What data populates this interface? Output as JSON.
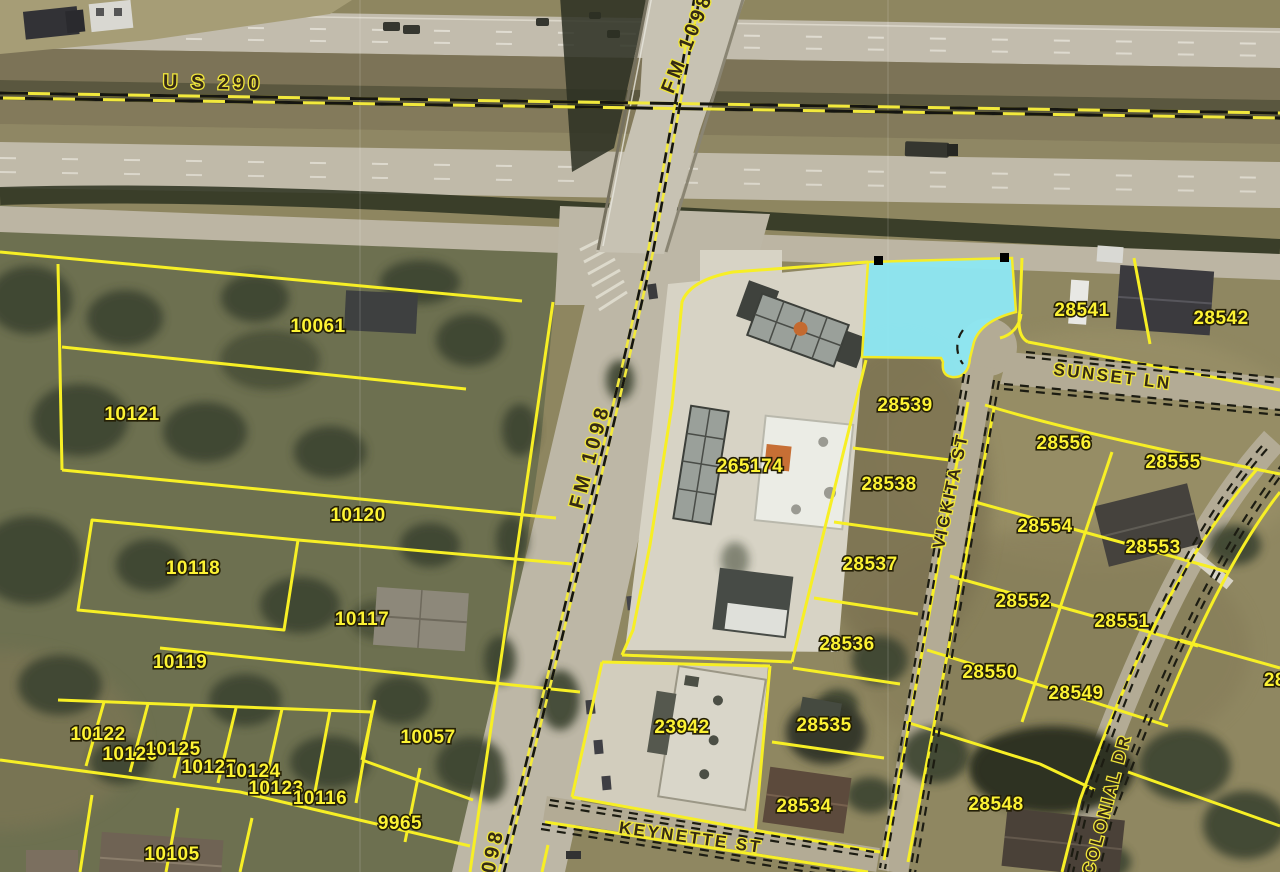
{
  "map": {
    "type": "aerial-parcel-map",
    "colors": {
      "parcel_line": "#f7ef25",
      "parcel_label_fill": "#fdf334",
      "street_label_fill": "#352a15",
      "highlight_parcel_fill": "#8ee7f2",
      "centerline_yellow": "#f2e93c",
      "centerline_black": "#151510"
    },
    "highways": [
      "U S 290",
      "FM 1098"
    ],
    "streets": [
      "SUNSET LN",
      "VICKITA ST",
      "KEYNETTE ST",
      "COLONIAL DR"
    ],
    "parcel_ids": [
      "10061",
      "10121",
      "10120",
      "10118",
      "10117",
      "10119",
      "10122",
      "10126",
      "10125",
      "10127",
      "10124",
      "10123",
      "10116",
      "10057",
      "9965",
      "10105",
      "265174",
      "23942",
      "28539",
      "28538",
      "28537",
      "28536",
      "28535",
      "28534",
      "28541",
      "28542",
      "28556",
      "28555",
      "28554",
      "28553",
      "28552",
      "28551",
      "28550",
      "28549",
      "28548",
      "2854"
    ],
    "highlighted_parcel": {
      "fill": "#8ee7f2",
      "location": "northeast corner of FM 1098 at US 290 frontage, west of 28541"
    },
    "labels": {
      "parcels": [
        {
          "text": "10061",
          "x": 318,
          "y": 332
        },
        {
          "text": "10121",
          "x": 132,
          "y": 420
        },
        {
          "text": "10120",
          "x": 358,
          "y": 521
        },
        {
          "text": "10118",
          "x": 193,
          "y": 574
        },
        {
          "text": "10117",
          "x": 362,
          "y": 625
        },
        {
          "text": "10119",
          "x": 180,
          "y": 668
        },
        {
          "text": "10122",
          "x": 98,
          "y": 740
        },
        {
          "text": "10126",
          "x": 130,
          "y": 760
        },
        {
          "text": "10125",
          "x": 173,
          "y": 755
        },
        {
          "text": "10127",
          "x": 209,
          "y": 773
        },
        {
          "text": "10124",
          "x": 253,
          "y": 777
        },
        {
          "text": "10123",
          "x": 276,
          "y": 794
        },
        {
          "text": "10116",
          "x": 320,
          "y": 804
        },
        {
          "text": "10057",
          "x": 428,
          "y": 743
        },
        {
          "text": "9965",
          "x": 400,
          "y": 829
        },
        {
          "text": "10105",
          "x": 172,
          "y": 860
        },
        {
          "text": "265174",
          "x": 750,
          "y": 472
        },
        {
          "text": "23942",
          "x": 682,
          "y": 733
        },
        {
          "text": "28539",
          "x": 905,
          "y": 411
        },
        {
          "text": "28538",
          "x": 889,
          "y": 490
        },
        {
          "text": "28537",
          "x": 870,
          "y": 570
        },
        {
          "text": "28536",
          "x": 847,
          "y": 650
        },
        {
          "text": "28535",
          "x": 824,
          "y": 731
        },
        {
          "text": "28534",
          "x": 804,
          "y": 812
        },
        {
          "text": "28541",
          "x": 1082,
          "y": 316
        },
        {
          "text": "28542",
          "x": 1221,
          "y": 324
        },
        {
          "text": "28556",
          "x": 1064,
          "y": 449
        },
        {
          "text": "28555",
          "x": 1173,
          "y": 468
        },
        {
          "text": "28554",
          "x": 1045,
          "y": 532
        },
        {
          "text": "28553",
          "x": 1153,
          "y": 553
        },
        {
          "text": "28552",
          "x": 1023,
          "y": 607
        },
        {
          "text": "28551",
          "x": 1122,
          "y": 627
        },
        {
          "text": "28550",
          "x": 990,
          "y": 678
        },
        {
          "text": "28549",
          "x": 1076,
          "y": 699
        },
        {
          "text": "28548",
          "x": 996,
          "y": 810
        },
        {
          "text": "2854",
          "x": 1286,
          "y": 686
        }
      ],
      "streets": [
        {
          "text": "U S 290",
          "x": 213,
          "y": 89,
          "rotate": 1,
          "cls": "hwy"
        },
        {
          "text": "FM 1098",
          "x": 693,
          "y": 45,
          "rotate": -68,
          "cls": "hwy"
        },
        {
          "text": "FM 1098",
          "x": 596,
          "y": 458,
          "rotate": -75,
          "cls": "hwy"
        },
        {
          "text": "098",
          "x": 499,
          "y": 852,
          "rotate": -78,
          "cls": "hwy"
        },
        {
          "text": "SUNSET LN",
          "x": 1112,
          "y": 382,
          "rotate": 7
        },
        {
          "text": "VICKITA ST",
          "x": 956,
          "y": 492,
          "rotate": -78
        },
        {
          "text": "KEYNETTE ST",
          "x": 690,
          "y": 843,
          "rotate": 8
        },
        {
          "text": "COLONIAL DR",
          "x": 1112,
          "y": 806,
          "rotate": -75
        }
      ]
    }
  }
}
